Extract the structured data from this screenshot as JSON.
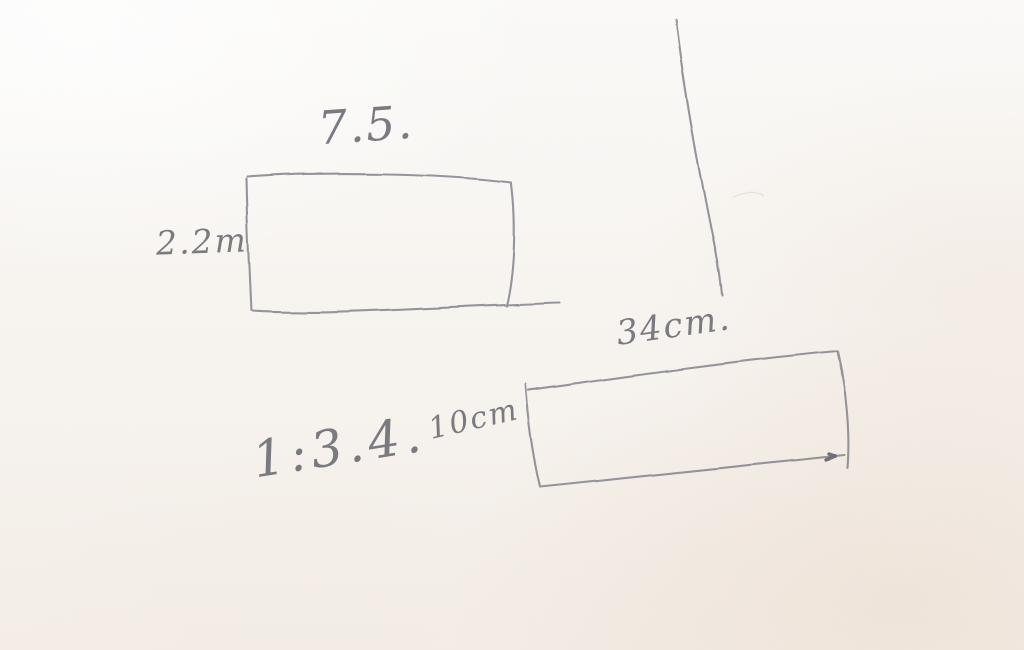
{
  "scene": {
    "description": "Hand-drawn pencil sketch on off-white paper: two rectangles with dimension labels, a scale ratio, and a stray vertical pencil line",
    "paper_color": "#f8f5f0",
    "pencil_color": "#7e7f86"
  },
  "diagram": {
    "rect1": {
      "width_label": "7.5.",
      "height_label": "2.2m"
    },
    "rect2": {
      "width_label": "34cm.",
      "height_label": "10cm"
    },
    "ratio_label": "1:3.4."
  }
}
